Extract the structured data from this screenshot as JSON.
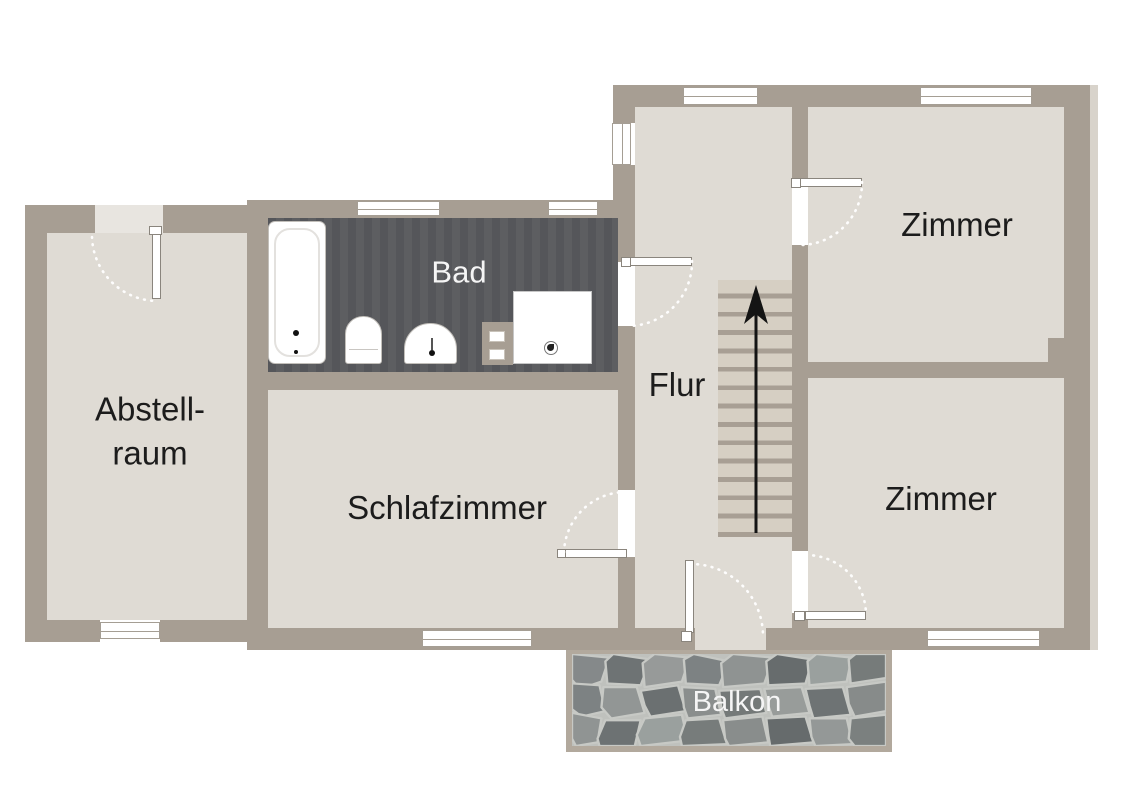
{
  "type": "floor-plan",
  "labels": {
    "abstellraum": [
      "Abstell-",
      "raum"
    ],
    "bad": "Bad",
    "schlafzimmer": "Schlafzimmer",
    "flur": "Flur",
    "zimmer_top": "Zimmer",
    "zimmer_bottom": "Zimmer",
    "balkon": "Balkon"
  },
  "features": {
    "stairs_treads": 14,
    "stairs_direction": "up",
    "bathroom_fixtures": [
      "bathtub",
      "toilet",
      "sink",
      "shower"
    ]
  },
  "colors": {
    "background": "#ffffff",
    "wall": "#a79e93",
    "floor": "#dfdbd4",
    "bad_floor": "#57585a",
    "stair_tread": "#d6cfc3",
    "stair_gap": "#a89f94",
    "door_arc": "#ffffff",
    "arrow": "#141414",
    "label_dark": "#1c1c1c",
    "label_light": "#f5f5f5",
    "balcony_border": "#b2a99d",
    "balcony_joint": "#c7c9c5"
  }
}
